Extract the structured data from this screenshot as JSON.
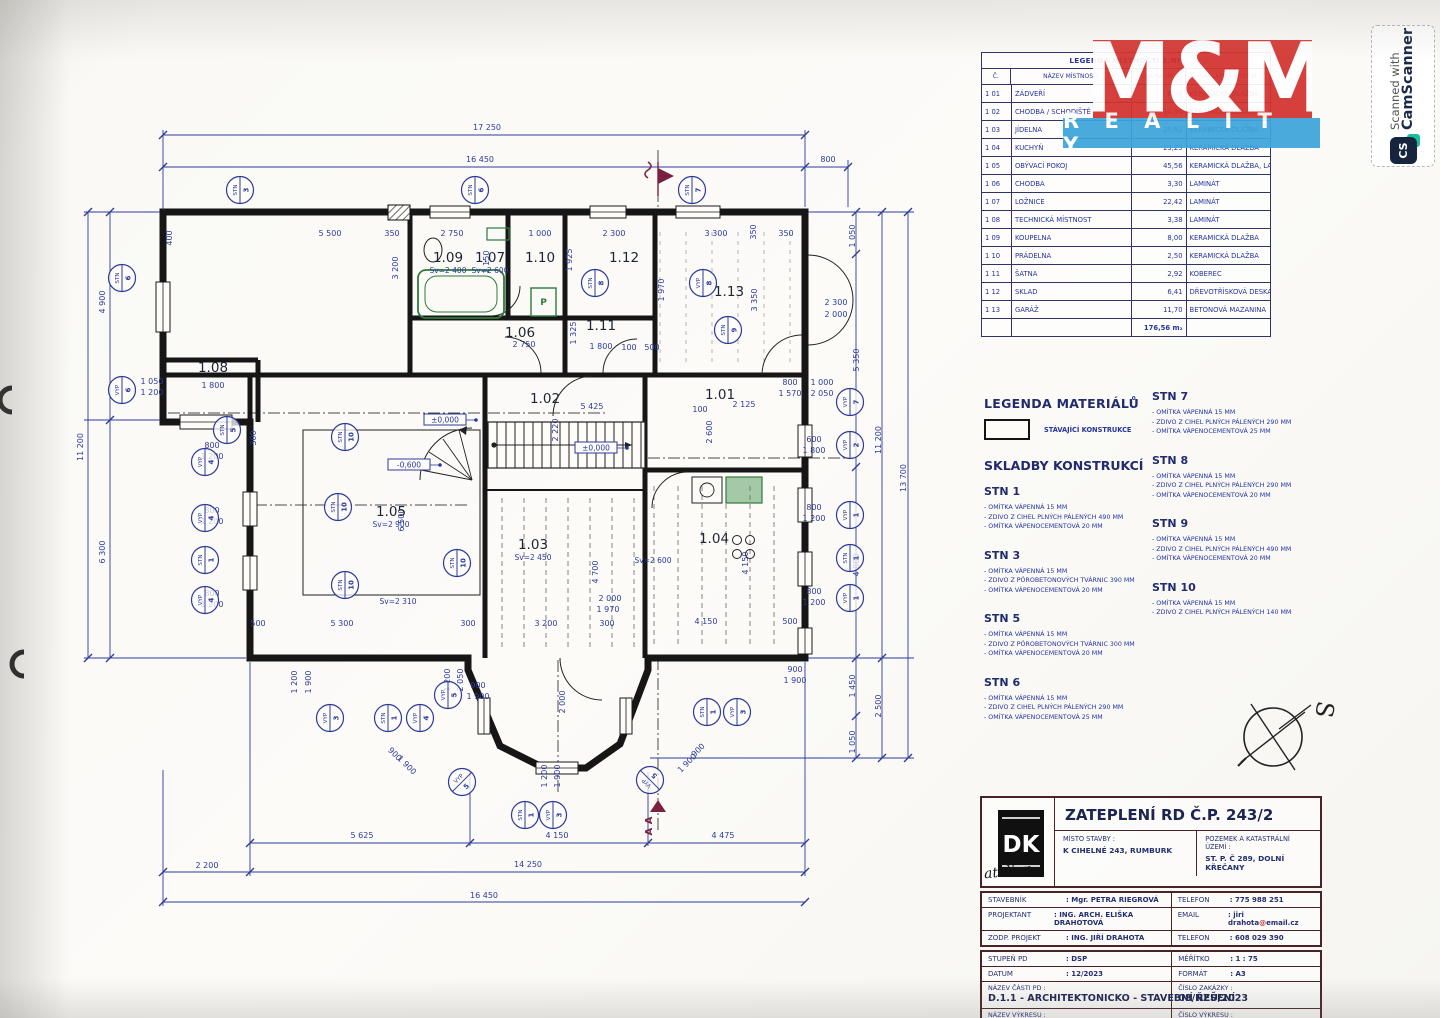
{
  "scan_badge": {
    "line1": "Scanned with",
    "line2": "CamScanner",
    "icon": "CS"
  },
  "brand": {
    "mm": "M&M",
    "reality": "R E A L I T Y",
    "red": "#d4322e",
    "blue": "#3da4d9"
  },
  "room_table": {
    "title": "LEGENDA MÍSTNOSTÍ 1.NP",
    "headers": [
      "Č.",
      "NÁZEV MÍSTNOSTI",
      "PLOCHA (M2)",
      "NÁŠLAPNÁ VRSTVA"
    ],
    "rows": [
      [
        "1 01",
        "ZÁDVEŘÍ",
        "6,56",
        "KERAMICKÁ DLAŽBA"
      ],
      [
        "1 02",
        "CHODBA / SCHODIŠTĚ",
        "14,94",
        "KERAMICKÁ DLAŽBA"
      ],
      [
        "1 03",
        "JÍDELNA",
        "25,62",
        "KERAMICKÁ DLAŽBA"
      ],
      [
        "1 04",
        "KUCHYŇ",
        "23,25",
        "KERAMICKÁ DLAŽBA"
      ],
      [
        "1 05",
        "OBÝVACÍ POKOJ",
        "45,56",
        "KERAMICKÁ DLAŽBA, LAMINÁT"
      ],
      [
        "1 06",
        "CHODBA",
        "3,30",
        "LAMINÁT"
      ],
      [
        "1 07",
        "LOŽNICE",
        "22,42",
        "LAMINÁT"
      ],
      [
        "1 08",
        "TECHNICKÁ MÍSTNOST",
        "3,38",
        "LAMINÁT"
      ],
      [
        "1 09",
        "KOUPELNA",
        "8,00",
        "KERAMICKÁ DLAŽBA"
      ],
      [
        "1 10",
        "PRÁDELNA",
        "2,50",
        "KERAMICKÁ DLAŽBA"
      ],
      [
        "1 11",
        "ŠATNA",
        "2,92",
        "KOBEREC"
      ],
      [
        "1 12",
        "SKLAD",
        "6,41",
        "DŘEVOTŘÍSKOVÁ DESKA"
      ],
      [
        "1 13",
        "GARÁŽ",
        "11,70",
        "BETONOVÁ MAZANINA"
      ]
    ],
    "total": "176,56 m₂"
  },
  "materials": {
    "title": "LEGENDA MATERIÁLŮ",
    "swatch_label": "STÁVAJÍCÍ KONSTRUKCE"
  },
  "skladby": {
    "title": "SKLADBY KONSTRUKCÍ",
    "left": [
      {
        "name": "STN 1",
        "lines": [
          "- OMÍTKA VÁPENNÁ  15 MM",
          "- ZDIVO Z CIHEL PLNÝCH PÁLENÝCH 490 MM",
          "- OMÍTKA VÁPENOCEMENTOVÁ  20 MM"
        ]
      },
      {
        "name": "STN 3",
        "lines": [
          "- OMÍTKA VÁPENNÁ  15 MM",
          "- ZDIVO Z PÓROBETONOVÝCH TVÁRNIC 390 MM",
          "- OMÍTKA VÁPENOCEMENTOVÁ  20 MM"
        ]
      },
      {
        "name": "STN 5",
        "lines": [
          "- OMÍTKA VÁPENNÁ  15 MM",
          "- ZDIVO Z PÓROBETONOVÝCH TVÁRNIC 300 MM",
          "- OMÍTKA VÁPENOCEMENTOVÁ  20 MM"
        ]
      },
      {
        "name": "STN 6",
        "lines": [
          "- OMÍTKA VÁPENNÁ  15 MM",
          "- ZDIVO Z CIHEL PLNÝCH PÁLENÝCH 290 MM",
          "- OMÍTKA VÁPENOCEMENTOVÁ  25 MM"
        ]
      }
    ],
    "right": [
      {
        "name": "STN 7",
        "lines": [
          "- OMÍTKA VÁPENNÁ  15 MM",
          "- ZDIVO Z CIHEL PLNÝCH PÁLENÝCH 290 MM",
          "- OMÍTKA VÁPENOCEMENTOVÁ  25 MM"
        ]
      },
      {
        "name": "STN 8",
        "lines": [
          "- OMÍTKA VÁPENNÁ  15 MM",
          "- ZDIVO Z CIHEL PLNÝCH PÁLENÝCH 290 MM",
          "- OMÍTKA VÁPENOCEMENTOVÁ  20 MM"
        ]
      },
      {
        "name": "STN 9",
        "lines": [
          "- OMÍTKA VÁPENNÁ  15 MM",
          "- ZDIVO Z CIHEL PLNÝCH PÁLENÝCH 490 MM",
          "- OMÍTKA VÁPENOCEMENTOVÁ  20 MM"
        ]
      },
      {
        "name": "STN 10",
        "lines": [
          "- OMÍTKA VÁPENNÁ  15 MM",
          "- ZDIVO Z CIHEL PLNÝCH PÁLENÝCH 140 MM"
        ]
      }
    ]
  },
  "titleblock": {
    "dk_logo": "DK",
    "dk_script": "atelier",
    "project_title": "ZATEPLENÍ RD Č.P. 243/2",
    "misto_label": "MÍSTO STAVBY :",
    "misto": "K CIHELNÉ 243, RUMBURK",
    "pozemek_label": "POZEMEK A KATASTRÁLNÍ ÚZEMÍ :",
    "pozemek": "ST. P. Č 289, DOLNÍ KŘEČANY",
    "people": [
      {
        "label": "STAVEBNÍK",
        "value": ": Mgr. PETRA RIEGROVÁ"
      },
      {
        "label": "PROJEKTANT",
        "value": ": ING. ARCH. ELIŠKA DRAHOTOVÁ"
      },
      {
        "label": "ZODP. PROJEKT",
        "value": ": ING. JIŘÍ DRAHOTA"
      }
    ],
    "contact1_label": "TELEFON",
    "contact1": ": 775 988 251",
    "contact2_label": "EMAIL",
    "email_pre": ": jiri drahota",
    "email_at": "@",
    "email_post": "email.cz",
    "contact3_label": "TELEFON",
    "contact3": ": 608 029 390",
    "stupen_label": "STUPEŇ PD",
    "stupen": ": DSP",
    "datum_label": "DATUM",
    "datum": ": 12/2023",
    "meritko_label": "MĚŘÍTKO",
    "meritko": ": 1 : 75",
    "format_label": "FORMÁT",
    "format": ": A3",
    "nazev_casti_label": "NÁZEV ČÁSTI PD :",
    "nazev_casti": "D.1.1 - ARCHITEKTONICKO - STAVEBNÍ ŘEŠENÍ",
    "cislo_zakazky_label": "ČÍSLO ZAKÁZKY :",
    "cislo_zakazky": "08/NZÚ/2023",
    "nazev_vykresu_label": "NÁZEV VÝKRESU :",
    "nazev_vykresu": "PŮDORYS 1.NP - STÁVAJÍCÍ STAV",
    "cislo_vykresu_label": "ČÍSLO VÝKRESU :",
    "cislo_vykresu": "01"
  },
  "plan": {
    "ink": "#2c3a9c",
    "wall": "#161616",
    "green": "#2f7a3d",
    "red": "#7a2040",
    "north_label": "S",
    "rooms": [
      {
        "id": "1.07",
        "x": 490,
        "y": 262,
        "sub": "Sv=2 600"
      },
      {
        "id": "1.09",
        "x": 448,
        "y": 262,
        "sub": "Sv=2 400"
      },
      {
        "id": "1.10",
        "x": 540,
        "y": 262
      },
      {
        "id": "1.12",
        "x": 624,
        "y": 262
      },
      {
        "id": "1.13",
        "x": 729,
        "y": 296
      },
      {
        "id": "1.06",
        "x": 520,
        "y": 337
      },
      {
        "id": "1.11",
        "x": 601,
        "y": 330
      },
      {
        "id": "1.08",
        "x": 213,
        "y": 372
      },
      {
        "id": "1.05",
        "x": 391,
        "y": 516,
        "sub": "Sv=2 900"
      },
      {
        "id": "1.02",
        "x": 545,
        "y": 403
      },
      {
        "id": "1.03",
        "x": 533,
        "y": 549,
        "sub": "Sv=2 450"
      },
      {
        "id": "1.01",
        "x": 720,
        "y": 399
      },
      {
        "id": "1.04",
        "x": 714,
        "y": 543
      }
    ],
    "notes": [
      {
        "t": "Sv=2 310",
        "x": 398,
        "y": 604
      },
      {
        "t": "Sv=2 600",
        "x": 653,
        "y": 563
      }
    ],
    "levels": [
      {
        "t": "±0,000",
        "x": 445,
        "y": 421
      },
      {
        "t": "-0,600",
        "x": 409,
        "y": 466
      },
      {
        "t": "±0,000",
        "x": 596,
        "y": 449
      }
    ],
    "dims": [
      {
        "t": "17 250",
        "x": 487,
        "y": 130
      },
      {
        "t": "16 450",
        "x": 480,
        "y": 162
      },
      {
        "t": "800",
        "x": 828,
        "y": 162
      },
      {
        "t": "5 625",
        "x": 362,
        "y": 838
      },
      {
        "t": "4 150",
        "x": 557,
        "y": 838
      },
      {
        "t": "4 475",
        "x": 723,
        "y": 838
      },
      {
        "t": "2 200",
        "x": 207,
        "y": 868
      },
      {
        "t": "14 250",
        "x": 528,
        "y": 867
      },
      {
        "t": "16 450",
        "x": 484,
        "y": 898
      },
      {
        "t": "11 200",
        "x": 83,
        "y": 447,
        "r": -90
      },
      {
        "t": "4 900",
        "x": 105,
        "y": 302,
        "r": -90
      },
      {
        "t": "6 300",
        "x": 105,
        "y": 552,
        "r": -90
      },
      {
        "t": "1 050",
        "x": 855,
        "y": 236,
        "r": -90
      },
      {
        "t": "5 350",
        "x": 859,
        "y": 360,
        "r": -90
      },
      {
        "t": "4 800",
        "x": 859,
        "y": 565,
        "r": -90
      },
      {
        "t": "1 450",
        "x": 855,
        "y": 686,
        "r": -90
      },
      {
        "t": "1 050",
        "x": 855,
        "y": 742,
        "r": -90
      },
      {
        "t": "11 200",
        "x": 881,
        "y": 440,
        "r": -90
      },
      {
        "t": "2 500",
        "x": 881,
        "y": 706,
        "r": -90
      },
      {
        "t": "13 700",
        "x": 906,
        "y": 478,
        "r": -90
      },
      {
        "t": "400",
        "x": 172,
        "y": 238,
        "r": -90
      },
      {
        "t": "5 500",
        "x": 330,
        "y": 236
      },
      {
        "t": "350",
        "x": 392,
        "y": 236
      },
      {
        "t": "2 750",
        "x": 452,
        "y": 236
      },
      {
        "t": "1 000",
        "x": 540,
        "y": 236
      },
      {
        "t": "2 300",
        "x": 614,
        "y": 236
      },
      {
        "t": "3 300",
        "x": 716,
        "y": 236
      },
      {
        "t": "350",
        "x": 756,
        "y": 232,
        "r": -90
      },
      {
        "t": "350",
        "x": 786,
        "y": 236
      },
      {
        "t": "3 200",
        "x": 398,
        "y": 268,
        "r": -90
      },
      {
        "t": "2 150",
        "x": 489,
        "y": 262,
        "r": -90
      },
      {
        "t": "1 925",
        "x": 572,
        "y": 260,
        "r": -90
      },
      {
        "t": "1 970",
        "x": 664,
        "y": 290,
        "r": -90
      },
      {
        "t": "3 350",
        "x": 757,
        "y": 300,
        "r": -90
      },
      {
        "t": "2 300",
        "x": 836,
        "y": 305
      },
      {
        "t": "2 000",
        "x": 836,
        "y": 317
      },
      {
        "t": "2 750",
        "x": 524,
        "y": 347
      },
      {
        "t": "1 325",
        "x": 576,
        "y": 333,
        "r": -90
      },
      {
        "t": "1 800",
        "x": 601,
        "y": 349
      },
      {
        "t": "100",
        "x": 629,
        "y": 350
      },
      {
        "t": "500",
        "x": 652,
        "y": 350
      },
      {
        "t": "1 800",
        "x": 213,
        "y": 388
      },
      {
        "t": "300",
        "x": 256,
        "y": 438,
        "r": -90
      },
      {
        "t": "5 425",
        "x": 592,
        "y": 409
      },
      {
        "t": "2 220",
        "x": 558,
        "y": 430,
        "r": -90
      },
      {
        "t": "6 500",
        "x": 404,
        "y": 520,
        "r": -90
      },
      {
        "t": "500",
        "x": 258,
        "y": 626
      },
      {
        "t": "5 300",
        "x": 342,
        "y": 626
      },
      {
        "t": "300",
        "x": 468,
        "y": 626
      },
      {
        "t": "3 200",
        "x": 546,
        "y": 626
      },
      {
        "t": "300",
        "x": 607,
        "y": 626
      },
      {
        "t": "4 150",
        "x": 706,
        "y": 624
      },
      {
        "t": "500",
        "x": 790,
        "y": 624
      },
      {
        "t": "4 700",
        "x": 598,
        "y": 572,
        "r": -90
      },
      {
        "t": "2 000",
        "x": 610,
        "y": 601
      },
      {
        "t": "1 970",
        "x": 608,
        "y": 612
      },
      {
        "t": "4 150",
        "x": 748,
        "y": 563,
        "r": -90
      },
      {
        "t": "2 125",
        "x": 744,
        "y": 407
      },
      {
        "t": "100",
        "x": 700,
        "y": 412
      },
      {
        "t": "2 600",
        "x": 712,
        "y": 432,
        "r": -90
      },
      {
        "t": "800",
        "x": 790,
        "y": 385
      },
      {
        "t": "1 570",
        "x": 790,
        "y": 396
      },
      {
        "t": "1 000",
        "x": 822,
        "y": 385
      },
      {
        "t": "2 050",
        "x": 822,
        "y": 396
      },
      {
        "t": "600",
        "x": 814,
        "y": 442
      },
      {
        "t": "1 800",
        "x": 814,
        "y": 453
      },
      {
        "t": "800",
        "x": 814,
        "y": 510
      },
      {
        "t": "1 200",
        "x": 814,
        "y": 521
      },
      {
        "t": "800",
        "x": 814,
        "y": 594
      },
      {
        "t": "1 200",
        "x": 814,
        "y": 605
      },
      {
        "t": "1 050",
        "x": 152,
        "y": 384
      },
      {
        "t": "1 200",
        "x": 152,
        "y": 395
      },
      {
        "t": "800",
        "x": 212,
        "y": 448
      },
      {
        "t": "1 200",
        "x": 212,
        "y": 459
      },
      {
        "t": "800",
        "x": 212,
        "y": 513
      },
      {
        "t": "1 200",
        "x": 212,
        "y": 524
      },
      {
        "t": "800",
        "x": 212,
        "y": 596
      },
      {
        "t": "1 200",
        "x": 212,
        "y": 607
      },
      {
        "t": "1 200",
        "x": 297,
        "y": 682,
        "r": -90
      },
      {
        "t": "1 900",
        "x": 311,
        "y": 682,
        "r": -90
      },
      {
        "t": "1 200",
        "x": 450,
        "y": 680,
        "r": -90
      },
      {
        "t": "2 050",
        "x": 463,
        "y": 680,
        "r": -90
      },
      {
        "t": "900",
        "x": 478,
        "y": 688
      },
      {
        "t": "1 900",
        "x": 478,
        "y": 699
      },
      {
        "t": "900",
        "x": 393,
        "y": 756,
        "r": 45
      },
      {
        "t": "1 900",
        "x": 405,
        "y": 767,
        "r": 45
      },
      {
        "t": "900",
        "x": 700,
        "y": 752,
        "r": -45
      },
      {
        "t": "1 900",
        "x": 689,
        "y": 765,
        "r": -45
      },
      {
        "t": "2 000",
        "x": 565,
        "y": 702,
        "r": -90
      },
      {
        "t": "1 200",
        "x": 547,
        "y": 776,
        "r": -90
      },
      {
        "t": "1 900",
        "x": 560,
        "y": 776,
        "r": -90
      },
      {
        "t": "900",
        "x": 795,
        "y": 672
      },
      {
        "t": "1 900",
        "x": 795,
        "y": 683
      }
    ],
    "markers": [
      {
        "t": "STN",
        "n": "3",
        "x": 240,
        "y": 190
      },
      {
        "t": "STN",
        "n": "6",
        "x": 475,
        "y": 190
      },
      {
        "t": "STN",
        "n": "7",
        "x": 692,
        "y": 190
      },
      {
        "t": "STN",
        "n": "6",
        "x": 122,
        "y": 278
      },
      {
        "t": "VYP",
        "n": "6",
        "x": 122,
        "y": 390
      },
      {
        "t": "STN",
        "n": "5",
        "x": 227,
        "y": 430
      },
      {
        "t": "VYP",
        "n": "4",
        "x": 205,
        "y": 462
      },
      {
        "t": "VYP",
        "n": "4",
        "x": 205,
        "y": 518
      },
      {
        "t": "STN",
        "n": "1",
        "x": 205,
        "y": 560
      },
      {
        "t": "VYP",
        "n": "4",
        "x": 205,
        "y": 600
      },
      {
        "t": "STN",
        "n": "10",
        "x": 345,
        "y": 437
      },
      {
        "t": "STN",
        "n": "10",
        "x": 338,
        "y": 507
      },
      {
        "t": "STN",
        "n": "10",
        "x": 345,
        "y": 585
      },
      {
        "t": "STN",
        "n": "10",
        "x": 457,
        "y": 563
      },
      {
        "t": "STN",
        "n": "8",
        "x": 595,
        "y": 283
      },
      {
        "t": "VYP",
        "n": "8",
        "x": 703,
        "y": 283
      },
      {
        "t": "STN",
        "n": "9",
        "x": 728,
        "y": 330
      },
      {
        "t": "VYP",
        "n": "7",
        "x": 850,
        "y": 402
      },
      {
        "t": "VYP",
        "n": "2",
        "x": 850,
        "y": 445
      },
      {
        "t": "VYP",
        "n": "1",
        "x": 850,
        "y": 515
      },
      {
        "t": "STN",
        "n": "1",
        "x": 850,
        "y": 558
      },
      {
        "t": "VYP",
        "n": "1",
        "x": 850,
        "y": 598
      },
      {
        "t": "VYP",
        "n": "3",
        "x": 330,
        "y": 718
      },
      {
        "t": "STN",
        "n": "1",
        "x": 388,
        "y": 718
      },
      {
        "t": "VYP",
        "n": "4",
        "x": 420,
        "y": 718
      },
      {
        "t": "VYP",
        "n": "5",
        "x": 448,
        "y": 695
      },
      {
        "t": "VYP",
        "n": "5",
        "x": 462,
        "y": 782,
        "r": 45
      },
      {
        "t": "VYP",
        "n": "5",
        "x": 650,
        "y": 780,
        "r": -45
      },
      {
        "t": "STN",
        "n": "1",
        "x": 525,
        "y": 815
      },
      {
        "t": "VYP",
        "n": "3",
        "x": 553,
        "y": 815
      },
      {
        "t": "STN",
        "n": "1",
        "x": 707,
        "y": 712
      },
      {
        "t": "VYP",
        "n": "3",
        "x": 737,
        "y": 712
      }
    ],
    "section_letters": "A A"
  }
}
